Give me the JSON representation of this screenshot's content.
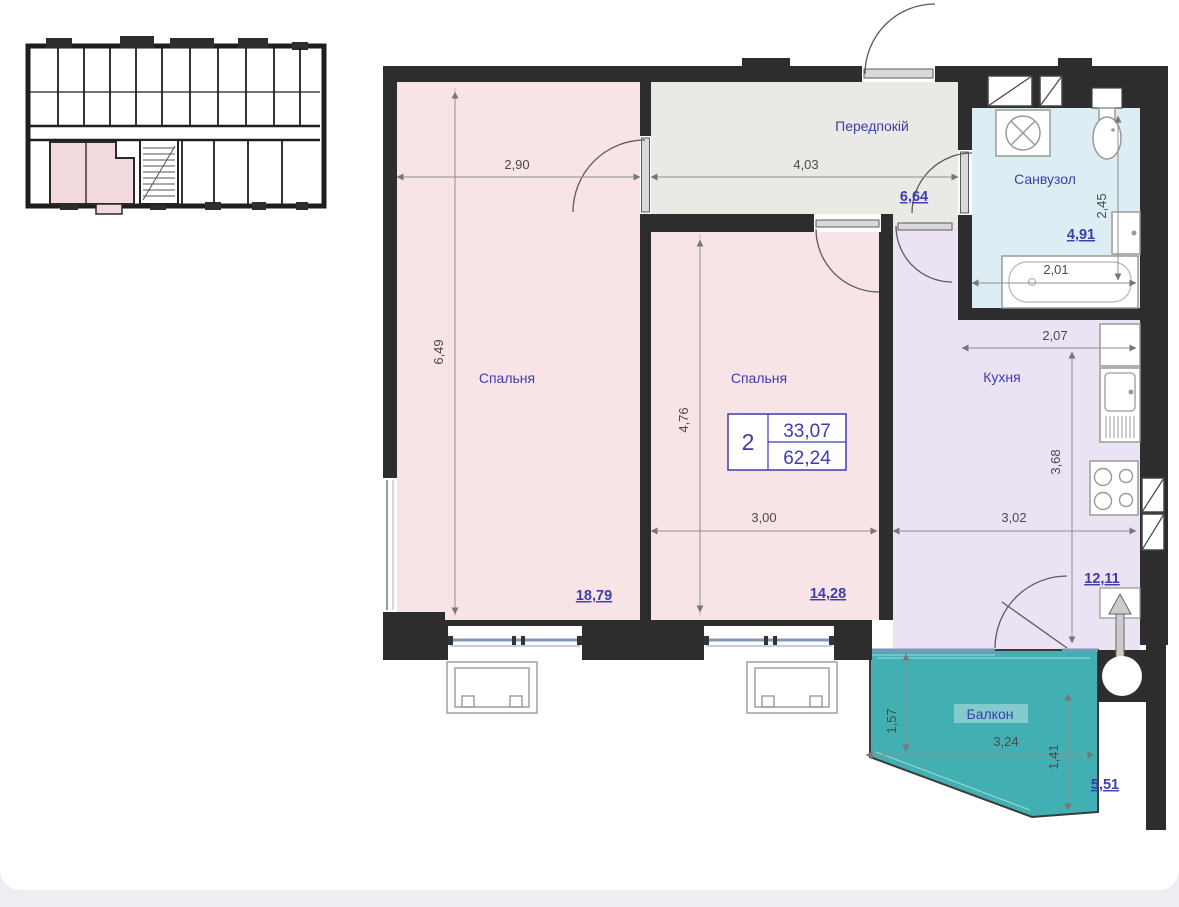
{
  "plan_title": "apartment floor plan",
  "info_box": {
    "rooms_count": "2",
    "area_living": "33,07",
    "area_total": "62,24"
  },
  "rooms": {
    "bedroom1": {
      "label": "Спальня",
      "area": "18,79",
      "dim_width": "2,90",
      "dim_height": "6,49"
    },
    "hallway": {
      "label": "Передпокій",
      "area": "6,64",
      "dim_width": "4,03"
    },
    "bedroom2": {
      "label": "Спальня",
      "area": "14,28",
      "dim_width": "3,00",
      "dim_height": "4,76"
    },
    "bathroom": {
      "label": "Санвузол",
      "area": "4,91",
      "dim_width": "2,01",
      "dim_height": "2,45"
    },
    "kitchen": {
      "label": "Кухня",
      "area": "12,11",
      "dim_width": "3,02",
      "dim_height": "3,68",
      "dim_top_width": "2,07"
    },
    "balcony": {
      "label": "Балкон",
      "area": "5,51",
      "dim_width": "3,24",
      "dim_left_height": "1,57",
      "dim_right_height": "1,41"
    }
  },
  "colors": {
    "wall": "#2d2d2d",
    "bedroom_fill": "#f8e4e6",
    "hallway_fill": "#e9e9e6",
    "bathroom_fill": "#dceef3",
    "kitchen_fill": "#ebe3f4",
    "balcony_fill": "#42b0b2",
    "label_blue": "#3d3dac",
    "window_blue": "#7e97b8",
    "page_background": "#eceef1",
    "card_background": "#ffffff"
  }
}
